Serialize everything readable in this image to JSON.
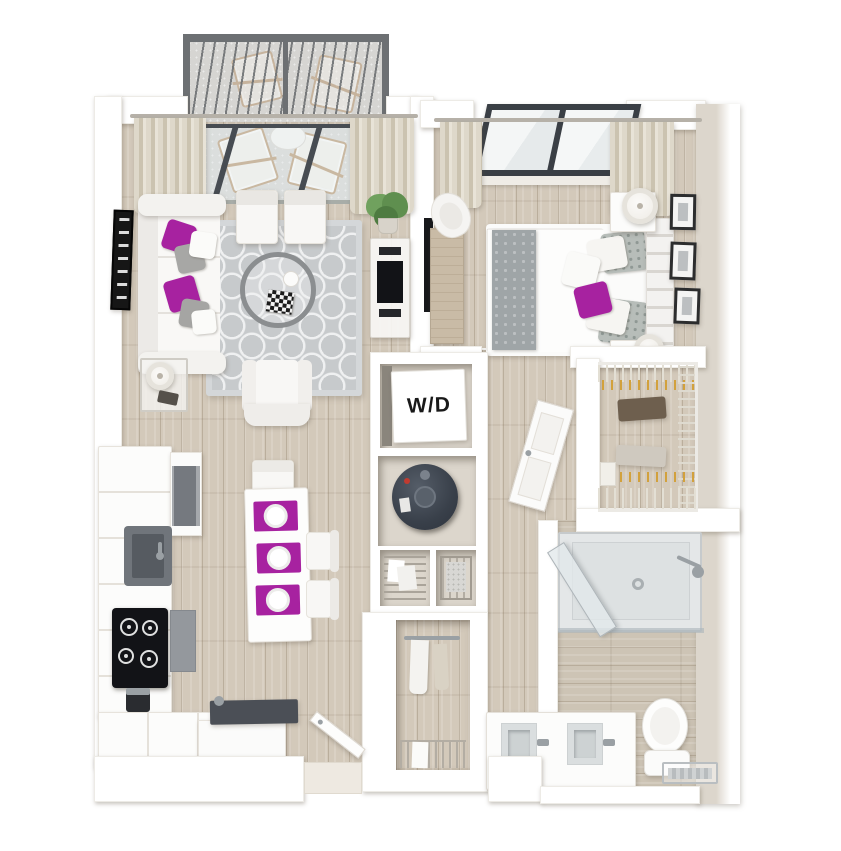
{
  "title": "One-bedroom apartment 3D floor plan",
  "labels": {
    "washer_dryer": "W/D"
  },
  "colors": {
    "bg": "#ffffff",
    "wall": "#ffffff",
    "wall_face": "#dcd6cc",
    "wood": "#d3c9ba",
    "bath_wood": "#cdc4b5",
    "concrete": "#d6d5d2",
    "railing": "#6d7073",
    "glass": "#dfe7ea",
    "frame_dark": "#3a3f45",
    "curtain": "#d8d1c2",
    "rug": "#c7cacc",
    "rug_pattern": "#eff0f1",
    "accent": "#a722a0",
    "fabric_gray": "#9fa5a7",
    "appliance_black": "#121317",
    "steel": "#94989d",
    "slate": "#3d444e",
    "desk_wood": "#c9bba6",
    "hanger": "#d2a13c",
    "plant": "#5f8f4f",
    "chrome": "#9aa0a4"
  },
  "scene": {
    "balcony": {
      "items": [
        "railing",
        "folding-chair",
        "folding-chair",
        "bistro-table"
      ]
    },
    "living_room": {
      "items": [
        "sofa",
        "accent-pillows",
        "area-rug",
        "round-coffee-table",
        "chess-board",
        "armchair",
        "side-table",
        "lamp",
        "accent-chair",
        "accent-chair",
        "media-console",
        "tv",
        "potted-plant",
        "wall-art",
        "curtains",
        "sliding-glass-door"
      ]
    },
    "dining": {
      "items": [
        "dining-table",
        "placemats",
        "plates",
        "chair",
        "chair",
        "chair"
      ]
    },
    "kitchen": {
      "items": [
        "l-shaped-counter",
        "sink",
        "faucet",
        "cooktop",
        "oven",
        "refrigerator",
        "dishwasher",
        "espresso-machine",
        "peninsula-console"
      ]
    },
    "bedroom": {
      "items": [
        "bed",
        "duvet",
        "gray-runner",
        "pillows",
        "tufted-headboard",
        "nightstand",
        "nightstand",
        "lamp",
        "lamp",
        "desk",
        "desk-chair",
        "wall-tv",
        "picture-frames",
        "window",
        "curtains"
      ]
    },
    "utility": {
      "items": [
        "washer-dryer",
        "water-heater",
        "wire-shelf-closet",
        "wire-basket-closet"
      ]
    },
    "entry": {
      "items": [
        "entry-door",
        "coat-closet",
        "wire-shelf"
      ]
    },
    "walk_in_closet": {
      "items": [
        "wire-shelving",
        "hangers",
        "clothes"
      ]
    },
    "bathroom": {
      "items": [
        "walk-in-shower",
        "shower-glass-door",
        "shower-head",
        "double-vanity",
        "sink",
        "sink",
        "toilet",
        "towel-rack"
      ]
    }
  }
}
